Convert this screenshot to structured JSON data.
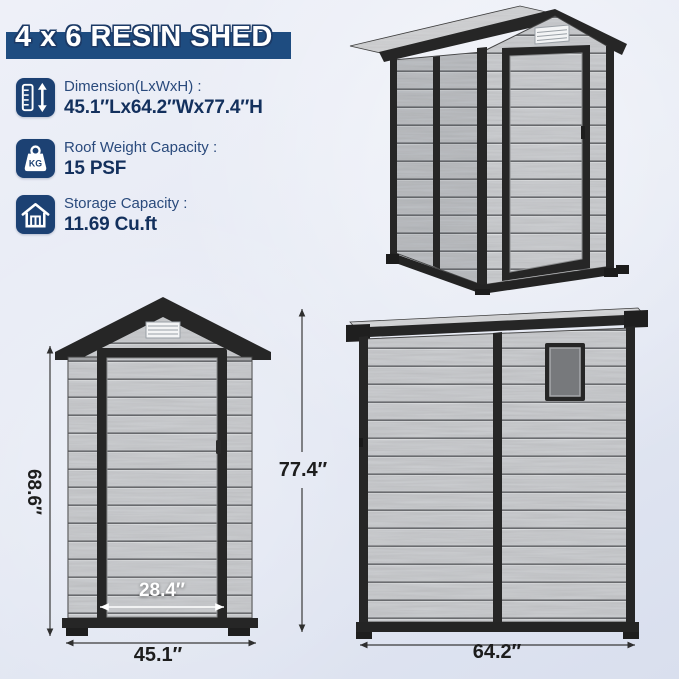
{
  "title": "4 x 6 RESIN SHED",
  "colors": {
    "banner_navy": "#1e4c80",
    "label_navy": "#2a4a7c",
    "value_navy": "#13305d",
    "trim_dark": "#262626",
    "siding_gray": "#cdcfd2",
    "dimension_text": "#1d1d1d"
  },
  "specs": [
    {
      "icon": "height-dimension-icon",
      "label": "Dimension(LxWxH) :",
      "value": "45.1″Lx64.2″Wx77.4″H"
    },
    {
      "icon": "roof-weight-kg-icon",
      "label": "Roof Weight Capacity :",
      "value": "15 PSF",
      "icon_badge": "KG"
    },
    {
      "icon": "storage-house-icon",
      "label": "Storage Capacity :",
      "value": "11.69 Cu.ft"
    }
  ],
  "dimensions": {
    "wall_height": "68.6″",
    "total_height": "77.4″",
    "door_width": "28.4″",
    "front_width": "45.1″",
    "side_width": "64.2″"
  },
  "views": {
    "perspective": "3d-shed-render",
    "front": "front-elevation-with-dimensions",
    "side": "side-elevation-with-dimensions"
  }
}
